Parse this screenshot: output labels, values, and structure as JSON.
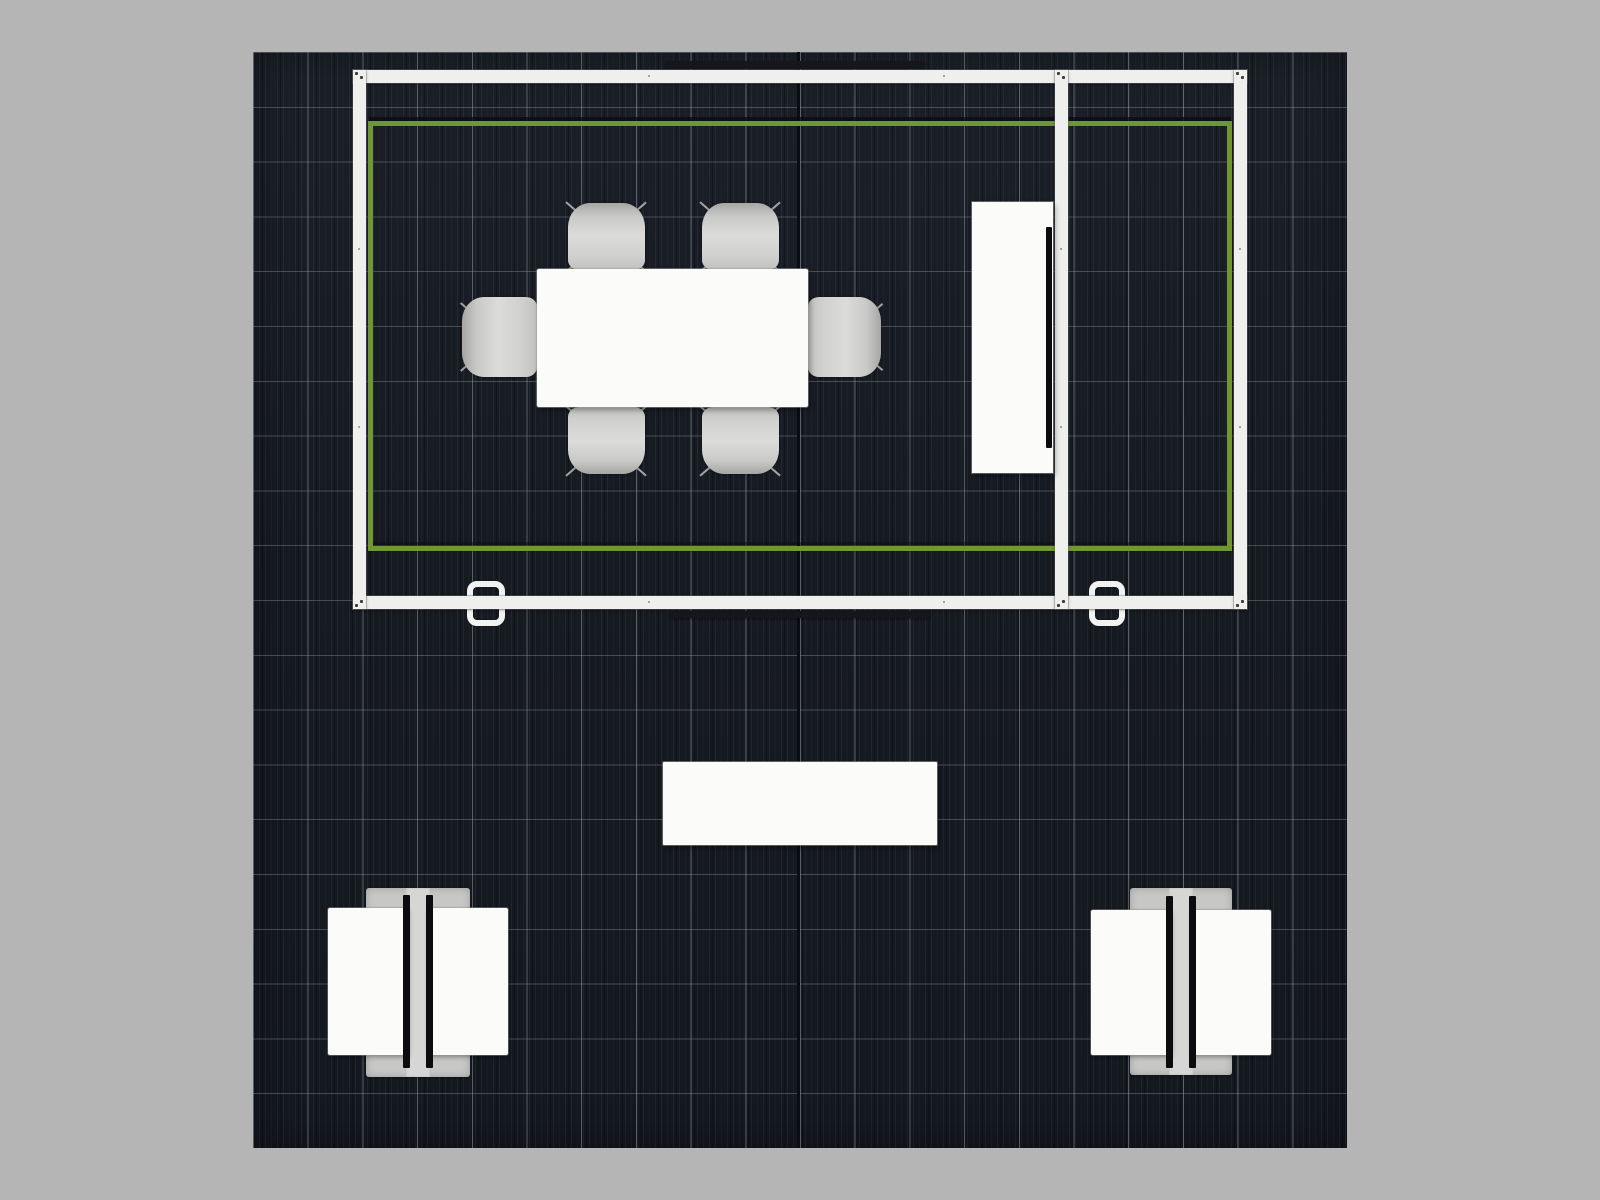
{
  "canvas": {
    "width": 1600,
    "height": 1200
  },
  "colors": {
    "background": "#b5b5b5",
    "floor_base": "#161a21",
    "floor_grid": "rgba(158,164,172,0.50)",
    "floor_seam": "#0a0d11",
    "wall_white": "#efefed",
    "accent_green": "#6f9733",
    "furniture_white": "#fbfbfa",
    "chair_gray": "#d2d2d0",
    "kiosk_base_gray": "#c7c7c5",
    "kiosk_strip_gray": "#d6d6d4",
    "monitor_black": "#0c0c0e",
    "sign_dark": "#15171c",
    "connector_dot": "#3a3c40"
  },
  "floor": {
    "x": 253,
    "y": 52,
    "width": 1094,
    "height": 1096,
    "tiles": 20,
    "tile_px": 54.7,
    "seam_local_x": 544,
    "seam_width": 3
  },
  "structure": {
    "walls": [
      {
        "name": "wall-top",
        "x": 353,
        "y": 70,
        "w": 894,
        "h": 13,
        "orient": "h"
      },
      {
        "name": "wall-bottom",
        "x": 353,
        "y": 596,
        "w": 894,
        "h": 13,
        "orient": "h"
      },
      {
        "name": "wall-left",
        "x": 353,
        "y": 70,
        "w": 13,
        "h": 539,
        "orient": "v"
      },
      {
        "name": "wall-divider",
        "x": 1055,
        "y": 70,
        "w": 13,
        "h": 539,
        "orient": "v"
      },
      {
        "name": "wall-right",
        "x": 1234,
        "y": 70,
        "w": 13,
        "h": 539,
        "orient": "v"
      }
    ],
    "green_outline": {
      "x": 368,
      "y": 121,
      "w": 864,
      "h": 430,
      "stroke": 5
    },
    "header_signs": [
      {
        "name": "sign-top",
        "x": 665,
        "y": 61,
        "w": 260,
        "h": 8
      },
      {
        "name": "sign-bottom",
        "x": 670,
        "y": 611,
        "w": 260,
        "h": 7
      }
    ],
    "door_handles": [
      {
        "name": "door-handle-meeting-room",
        "x": 467,
        "y": 581,
        "w": 38,
        "h": 45
      },
      {
        "name": "door-handle-storage-room",
        "x": 1089,
        "y": 581,
        "w": 36,
        "h": 45
      }
    ]
  },
  "furniture": {
    "media_cabinet": {
      "name": "media-cabinet",
      "x": 972,
      "y": 202,
      "w": 81,
      "h": 271,
      "screen": {
        "name": "tv-screen",
        "x": 1046,
        "y": 227,
        "w": 6,
        "h": 221
      }
    },
    "conference_table": {
      "name": "conference-table",
      "x": 537,
      "y": 269,
      "w": 271,
      "h": 138
    },
    "chairs": [
      {
        "name": "chair-top-left",
        "x": 568,
        "y": 203,
        "w": 77,
        "h": 67,
        "facing": "down"
      },
      {
        "name": "chair-top-right",
        "x": 702,
        "y": 203,
        "w": 77,
        "h": 67,
        "facing": "down"
      },
      {
        "name": "chair-left",
        "x": 462,
        "y": 297,
        "w": 75,
        "h": 80,
        "facing": "right"
      },
      {
        "name": "chair-right",
        "x": 808,
        "y": 297,
        "w": 73,
        "h": 80,
        "facing": "left"
      },
      {
        "name": "chair-bottom-left",
        "x": 568,
        "y": 407,
        "w": 77,
        "h": 67,
        "facing": "up"
      },
      {
        "name": "chair-bottom-right",
        "x": 702,
        "y": 407,
        "w": 77,
        "h": 67,
        "facing": "up"
      }
    ],
    "reception_counter": {
      "name": "reception-counter",
      "x": 663,
      "y": 762,
      "w": 274,
      "h": 83
    },
    "kiosks": [
      {
        "name": "monitor-kiosk-left",
        "cx": 418,
        "base": {
          "y": 888,
          "w": 104,
          "h": 189
        },
        "strip_w": 24,
        "counter": {
          "y": 908,
          "w": 80,
          "h": 147,
          "gap": 10
        },
        "monitor": {
          "y": 895,
          "w": 7,
          "h": 173,
          "center_offset": 11.5
        }
      },
      {
        "name": "monitor-kiosk-right",
        "cx": 1181,
        "base": {
          "y": 888,
          "w": 102,
          "h": 187
        },
        "strip_w": 24,
        "counter": {
          "y": 910,
          "w": 80,
          "h": 145,
          "gap": 10
        },
        "monitor": {
          "y": 896,
          "w": 7,
          "h": 172,
          "center_offset": 11.5
        }
      }
    ]
  }
}
